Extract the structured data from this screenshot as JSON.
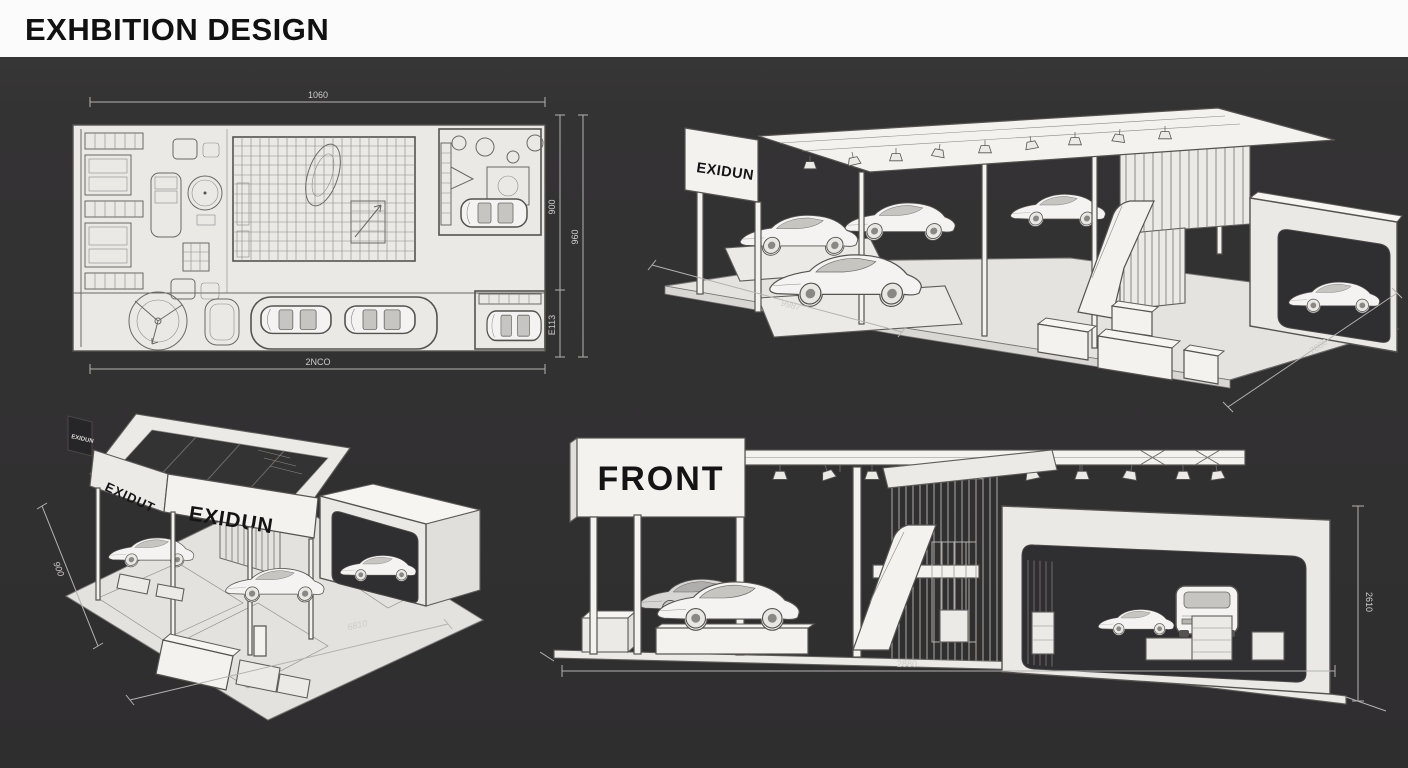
{
  "header": {
    "title": "EXHBITION DESIGN"
  },
  "colors": {
    "background": "#343334",
    "header_bg": "#fbfbfb",
    "panel": "#eae9e6",
    "line": "#55524f",
    "opening": "#2f2e30",
    "dimension": "#cdccca"
  },
  "views": {
    "floor_plan": {
      "name": "top-view floor plan",
      "dims": {
        "top": "1060",
        "bottom": "2NCO",
        "right_upper": "900",
        "right_lower": "E113",
        "right_outer": "960"
      }
    },
    "perspective_right": {
      "sign": "EXIDUN",
      "dims": {
        "front": "9987",
        "right": "7000"
      }
    },
    "perspective_left": {
      "sign_front": "EXIDUN",
      "sign_side": "EXIDUT",
      "sign_small": "EXIDUN",
      "dims": {
        "left": "900",
        "bottom": "6810"
      }
    },
    "front_elevation": {
      "label": "FRONT",
      "dims": {
        "bottom": "2880",
        "right": "2610"
      }
    }
  }
}
